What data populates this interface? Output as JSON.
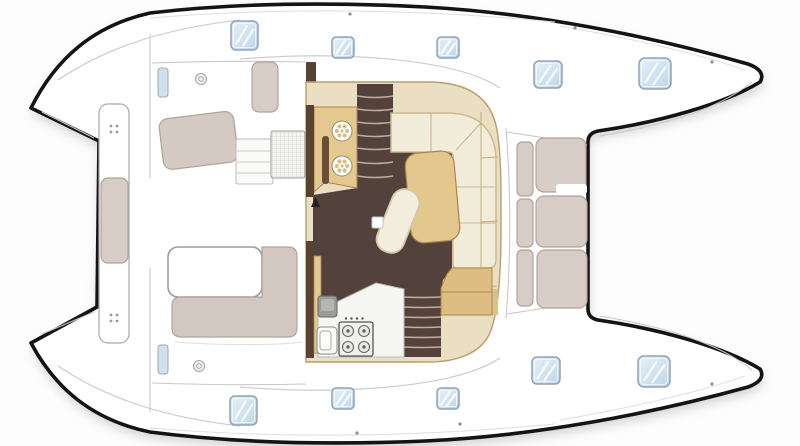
{
  "title": "Catamaran deck and salon floor plan (top view)",
  "colors": {
    "background": "#fdfdfd",
    "outline": "#141414",
    "hull_white": "#ffffff",
    "deck_line": "#c9c9c9",
    "hatch_glass": "#bdd6ea",
    "hatch_glass_light": "#e6f0f8",
    "hatch_frame": "#8fa3b3",
    "cream_band": "#eadfc2",
    "band_edge": "#bb9d6b",
    "tan_counter": "#e3c88f",
    "tan_dark_edge": "#a9854e",
    "table_tan": "#e4c78c",
    "floor_brown": "#53413b",
    "tread_line": "#bfae9b",
    "wall_brown": "#5a4233",
    "fiddle_brown": "#6b4f35",
    "sofa_cream": "#f2ecda",
    "sofa_edge": "#cbb88f",
    "cushion_gray": "#d7ccc6",
    "cushion_edge": "#b2a399",
    "bench_gray": "#d3c8c1",
    "white_counter": "#f5f5f2",
    "appliance_gray": "#9a9a98"
  },
  "hatches": [
    {
      "x": 231,
      "y": 21,
      "w": 27,
      "h": 29,
      "rx": 5
    },
    {
      "x": 332,
      "y": 37,
      "w": 22,
      "h": 21,
      "rx": 4
    },
    {
      "x": 437,
      "y": 37,
      "w": 22,
      "h": 21,
      "rx": 4
    },
    {
      "x": 534,
      "y": 61,
      "w": 28,
      "h": 27,
      "rx": 5
    },
    {
      "x": 639,
      "y": 58,
      "w": 32,
      "h": 31,
      "rx": 6
    },
    {
      "x": 230,
      "y": 396,
      "w": 27,
      "h": 29,
      "rx": 5
    },
    {
      "x": 332,
      "y": 388,
      "w": 22,
      "h": 21,
      "rx": 4
    },
    {
      "x": 437,
      "y": 388,
      "w": 22,
      "h": 21,
      "rx": 4
    },
    {
      "x": 532,
      "y": 357,
      "w": 28,
      "h": 27,
      "rx": 5
    },
    {
      "x": 638,
      "y": 356,
      "w": 32,
      "h": 31,
      "rx": 6
    }
  ],
  "fwd_cushions": [
    {
      "x": 517,
      "y": 142,
      "w": 16,
      "h": 54,
      "rx": 5
    },
    {
      "x": 517,
      "y": 199,
      "w": 16,
      "h": 48,
      "rx": 5
    },
    {
      "x": 517,
      "y": 250,
      "w": 16,
      "h": 56,
      "rx": 5
    },
    {
      "x": 536,
      "y": 138,
      "w": 50,
      "h": 54,
      "rx": 8
    },
    {
      "x": 536,
      "y": 196,
      "w": 51,
      "h": 51,
      "rx": 8
    },
    {
      "x": 537,
      "y": 250,
      "w": 50,
      "h": 58,
      "rx": 8
    }
  ],
  "stairs": [
    {
      "x1": 357,
      "x2": 393,
      "sag": 3,
      "ys": [
        96,
        109,
        122,
        135,
        148,
        162,
        176
      ]
    },
    {
      "x1": 404,
      "x2": 441,
      "sag": 1,
      "ys": [
        297,
        307,
        317,
        327,
        337,
        347
      ]
    }
  ],
  "burners": [
    [
      348,
      331
    ],
    [
      364,
      331
    ],
    [
      348,
      347
    ],
    [
      364,
      347
    ]
  ],
  "stove_knobs": [
    [
      346,
      318.5
    ],
    [
      351.5,
      318.5
    ],
    [
      357,
      318.5
    ],
    [
      362.5,
      318.5
    ]
  ],
  "sinks": [
    [
      342,
      131
    ],
    [
      342,
      166
    ]
  ],
  "cleats": [
    [
      114,
      129
    ],
    [
      114,
      318
    ]
  ],
  "deck_dots": [
    [
      350,
      14
    ],
    [
      575,
      28
    ],
    [
      712,
      62
    ],
    [
      712,
      384
    ],
    [
      460,
      424
    ],
    [
      357,
      433
    ]
  ]
}
